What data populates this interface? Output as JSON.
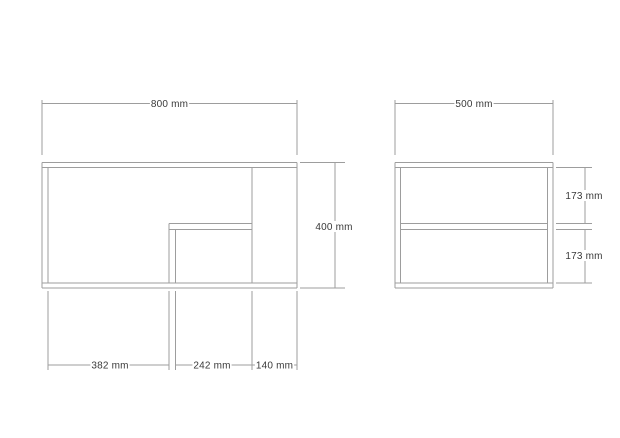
{
  "canvas": {
    "width": 620,
    "height": 438,
    "background": "#ffffff",
    "line_color": "#9d9d9d",
    "text_color": "#3a3a3a"
  },
  "views": {
    "front_view": {
      "width_label": "800 mm",
      "height_label": "400 mm",
      "bottom_segment_labels": [
        "382 mm",
        "242 mm",
        "140 mm"
      ]
    },
    "side_view": {
      "width_label": "500 mm",
      "compartment_labels": [
        "173 mm",
        "173 mm"
      ]
    }
  },
  "drawing": {
    "lines": [
      {
        "name": "front-top-board-top-edge",
        "x1": 42,
        "y1": 162.5,
        "x2": 297,
        "y2": 162.5
      },
      {
        "name": "front-top-board-bottom-edge",
        "x1": 42,
        "y1": 167.5,
        "x2": 297,
        "y2": 167.5
      },
      {
        "name": "front-left-wall-outer-edge",
        "x1": 42,
        "y1": 162.5,
        "x2": 42,
        "y2": 288
      },
      {
        "name": "front-left-wall-inner-edge",
        "x1": 48,
        "y1": 167.5,
        "x2": 48,
        "y2": 283
      },
      {
        "name": "front-bottom-board-top-edge",
        "x1": 42,
        "y1": 283,
        "x2": 297,
        "y2": 283
      },
      {
        "name": "front-bottom-board-bottom-edge",
        "x1": 42,
        "y1": 288,
        "x2": 297,
        "y2": 288
      },
      {
        "name": "front-right-outer-edge",
        "x1": 297,
        "y1": 162.5,
        "x2": 297,
        "y2": 288
      },
      {
        "name": "front-partition-edge",
        "x1": 252,
        "y1": 167.5,
        "x2": 252,
        "y2": 283
      },
      {
        "name": "front-shelf-top-edge",
        "x1": 169,
        "y1": 223.5,
        "x2": 252,
        "y2": 223.5
      },
      {
        "name": "front-shelf-bottom-edge",
        "x1": 169,
        "y1": 229.5,
        "x2": 252,
        "y2": 229.5
      },
      {
        "name": "front-support-outer-edge",
        "x1": 169,
        "y1": 223.5,
        "x2": 169,
        "y2": 283
      },
      {
        "name": "front-support-inner-edge",
        "x1": 175.5,
        "y1": 229.5,
        "x2": 175.5,
        "y2": 283
      },
      {
        "name": "front-width-dim-ext-left",
        "x1": 42,
        "y1": 100,
        "x2": 42,
        "y2": 155
      },
      {
        "name": "front-width-dim-ext-right",
        "x1": 297,
        "y1": 100,
        "x2": 297,
        "y2": 155
      },
      {
        "name": "front-width-dim-line",
        "x1": 42,
        "y1": 103.5,
        "x2": 297,
        "y2": 103.5
      },
      {
        "name": "front-height-dim-ext-top",
        "x1": 300,
        "y1": 162.5,
        "x2": 345,
        "y2": 162.5
      },
      {
        "name": "front-height-dim-ext-bottom",
        "x1": 300,
        "y1": 288,
        "x2": 345,
        "y2": 288
      },
      {
        "name": "front-height-dim-line",
        "x1": 335,
        "y1": 162.5,
        "x2": 335,
        "y2": 288
      },
      {
        "name": "front-bottom-dim-ext-1",
        "x1": 48,
        "y1": 291,
        "x2": 48,
        "y2": 370
      },
      {
        "name": "front-bottom-dim-ext-2",
        "x1": 169,
        "y1": 291,
        "x2": 169,
        "y2": 370
      },
      {
        "name": "front-bottom-dim-ext-3",
        "x1": 175.5,
        "y1": 291,
        "x2": 175.5,
        "y2": 370
      },
      {
        "name": "front-bottom-dim-ext-4",
        "x1": 252,
        "y1": 291,
        "x2": 252,
        "y2": 370
      },
      {
        "name": "front-bottom-dim-ext-5",
        "x1": 297,
        "y1": 291,
        "x2": 297,
        "y2": 370
      },
      {
        "name": "front-bottom-dim-line-a",
        "x1": 48,
        "y1": 365,
        "x2": 169,
        "y2": 365
      },
      {
        "name": "front-bottom-dim-line-b",
        "x1": 175.5,
        "y1": 365,
        "x2": 297,
        "y2": 365
      },
      {
        "name": "side-top-board-top-edge",
        "x1": 395,
        "y1": 162.5,
        "x2": 553,
        "y2": 162.5
      },
      {
        "name": "side-top-board-bottom-edge",
        "x1": 395,
        "y1": 167.5,
        "x2": 553,
        "y2": 167.5
      },
      {
        "name": "side-left-wall-outer-edge",
        "x1": 395,
        "y1": 162.5,
        "x2": 395,
        "y2": 288
      },
      {
        "name": "side-left-wall-inner-edge",
        "x1": 400.5,
        "y1": 167.5,
        "x2": 400.5,
        "y2": 283
      },
      {
        "name": "side-right-wall-outer-edge",
        "x1": 553,
        "y1": 162.5,
        "x2": 553,
        "y2": 288
      },
      {
        "name": "side-right-wall-inner-edge",
        "x1": 547.5,
        "y1": 167.5,
        "x2": 547.5,
        "y2": 283
      },
      {
        "name": "side-bottom-board-top-edge",
        "x1": 395,
        "y1": 283,
        "x2": 553,
        "y2": 283
      },
      {
        "name": "side-bottom-board-bottom-edge",
        "x1": 395,
        "y1": 288,
        "x2": 553,
        "y2": 288
      },
      {
        "name": "side-shelf-top-edge",
        "x1": 400.5,
        "y1": 223.5,
        "x2": 547.5,
        "y2": 223.5
      },
      {
        "name": "side-shelf-bottom-edge",
        "x1": 400.5,
        "y1": 229.5,
        "x2": 547.5,
        "y2": 229.5
      },
      {
        "name": "side-width-dim-ext-left",
        "x1": 395,
        "y1": 100,
        "x2": 395,
        "y2": 155
      },
      {
        "name": "side-width-dim-ext-right",
        "x1": 553,
        "y1": 100,
        "x2": 553,
        "y2": 155
      },
      {
        "name": "side-width-dim-line",
        "x1": 395,
        "y1": 103.5,
        "x2": 553,
        "y2": 103.5
      },
      {
        "name": "side-right-dim-ext-top",
        "x1": 556,
        "y1": 167.5,
        "x2": 592,
        "y2": 167.5
      },
      {
        "name": "side-right-dim-ext-shelf-top",
        "x1": 556,
        "y1": 223.5,
        "x2": 592,
        "y2": 223.5
      },
      {
        "name": "side-right-dim-ext-shelf-bot",
        "x1": 556,
        "y1": 229.5,
        "x2": 592,
        "y2": 229.5
      },
      {
        "name": "side-right-dim-ext-bottom",
        "x1": 556,
        "y1": 283,
        "x2": 592,
        "y2": 283
      },
      {
        "name": "side-right-dim-line-upper",
        "x1": 585,
        "y1": 167.5,
        "x2": 585,
        "y2": 223.5
      },
      {
        "name": "side-right-dim-line-lower",
        "x1": 585,
        "y1": 229.5,
        "x2": 585,
        "y2": 283
      }
    ],
    "labels": [
      {
        "name": "front-width-dim-label",
        "text": "800 mm",
        "x": 169.5,
        "y": 103.5
      },
      {
        "name": "front-height-dim-label",
        "text": "400 mm",
        "x": 334,
        "y": 226.5
      },
      {
        "name": "front-bottom-dim-label-1",
        "text": "382 mm",
        "x": 110,
        "y": 365
      },
      {
        "name": "front-bottom-dim-label-2",
        "text": "242 mm",
        "x": 212,
        "y": 365
      },
      {
        "name": "front-bottom-dim-label-3",
        "text": "140 mm",
        "x": 274.5,
        "y": 365
      },
      {
        "name": "side-width-dim-label",
        "text": "500 mm",
        "x": 474,
        "y": 103.5
      },
      {
        "name": "side-right-dim-label-1",
        "text": "173 mm",
        "x": 584,
        "y": 195.5
      },
      {
        "name": "side-right-dim-label-2",
        "text": "173 mm",
        "x": 584,
        "y": 255.5
      }
    ]
  }
}
